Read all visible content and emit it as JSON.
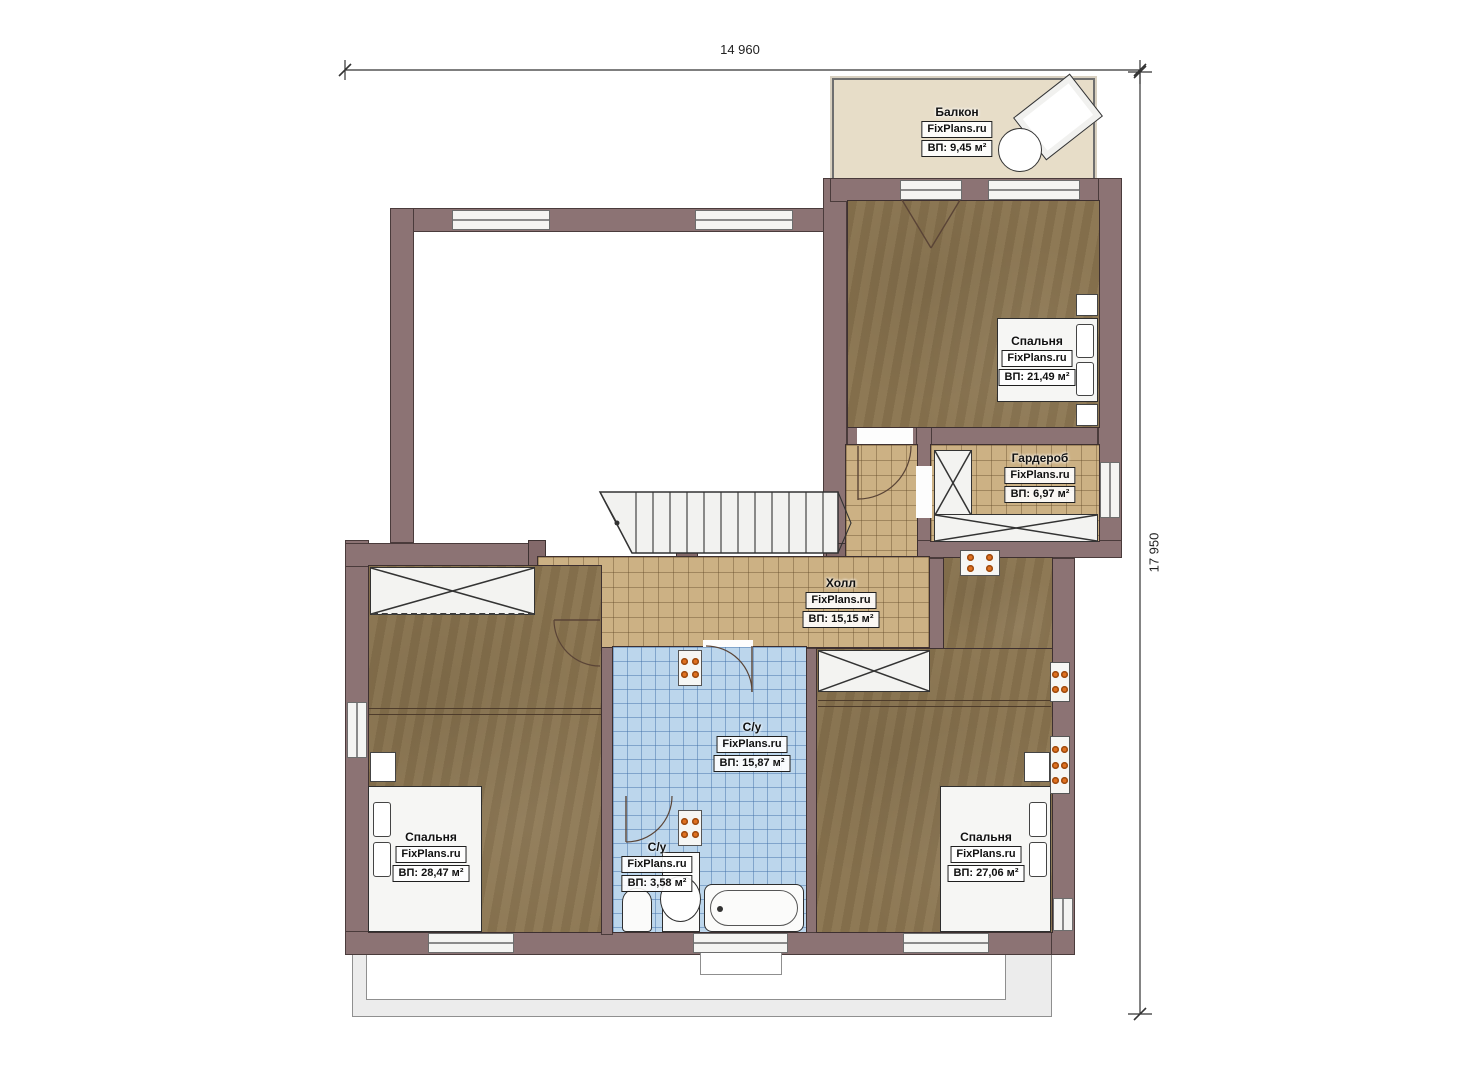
{
  "dimensions": {
    "width_label": "14 960",
    "height_label": "17 950"
  },
  "rooms": {
    "balcony": {
      "name": "Балкон",
      "brand": "FixPlans.ru",
      "area": "ВП: 9,45 м²"
    },
    "bedroom_tr": {
      "name": "Спальня",
      "brand": "FixPlans.ru",
      "area": "ВП: 21,49 м²"
    },
    "wardrobe": {
      "name": "Гардероб",
      "brand": "FixPlans.ru",
      "area": "ВП: 6,97 м²"
    },
    "hall": {
      "name": "Холл",
      "brand": "FixPlans.ru",
      "area": "ВП: 15,15 м²"
    },
    "bathroom_main": {
      "name": "С/у",
      "brand": "FixPlans.ru",
      "area": "ВП: 15,87 м²"
    },
    "bathroom_small": {
      "name": "С/у",
      "brand": "FixPlans.ru",
      "area": "ВП: 3,58 м²"
    },
    "bedroom_bl": {
      "name": "Спальня",
      "brand": "FixPlans.ru",
      "area": "ВП: 28,47 м²"
    },
    "bedroom_br": {
      "name": "Спальня",
      "brand": "FixPlans.ru",
      "area": "ВП: 27,06 м²"
    }
  },
  "colors": {
    "wall": "#8c7374",
    "wood_floor": "#8a744f",
    "tile_tan": "#ccb184",
    "tile_blue": "#bcd6ec",
    "balcony_floor": "#e7ddc8",
    "accent_orange": "#e0701f"
  }
}
